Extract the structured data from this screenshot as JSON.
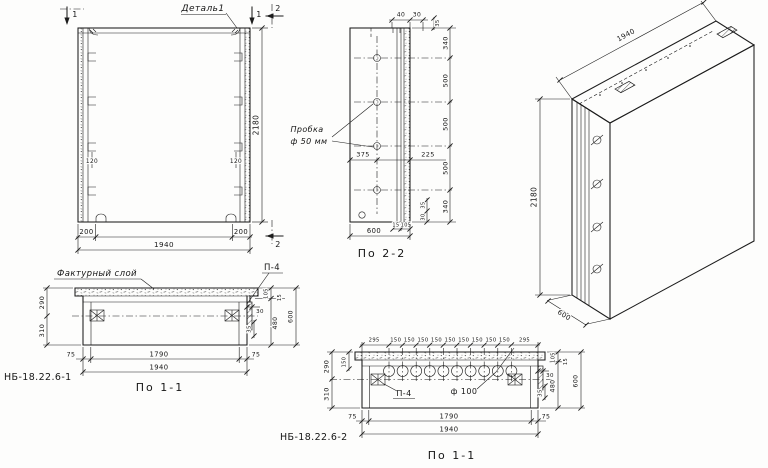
{
  "colors": {
    "ink": "#1c1c1c",
    "paper": "#fdfdfc"
  },
  "front": {
    "detail_label": "Деталь1",
    "sec1_left": "1",
    "sec1_right": "1",
    "sec2_top": "2",
    "sec2_bottom": "2",
    "dim_height": "2180",
    "dim_rib_left": "200",
    "dim_rib_right": "200",
    "dim_width": "1940",
    "key_left": "120",
    "key_right": "120"
  },
  "sec22": {
    "title": "По 2-2",
    "plug_line1": "Пробка",
    "plug_line2": "ф 50 мм",
    "dim_40": "40",
    "dim_30": "30",
    "dim_35_top": "35",
    "dim_375": "375",
    "dim_225": "225",
    "chain": [
      "340",
      "500",
      "500",
      "500",
      "340"
    ],
    "dim_15": "15",
    "dim_105": "105",
    "dim_30_rot": "30",
    "dim_35_rot": "35",
    "dim_600": "600"
  },
  "iso": {
    "dim_length": "1940",
    "dim_height": "2180",
    "dim_depth": "600"
  },
  "sec11a": {
    "mark": "НБ-18.22.6-1",
    "title": "По 1-1",
    "facing_label": "Фактурный слой",
    "p4": "П-4",
    "d290": "290",
    "d310": "310",
    "d30": "30",
    "d35": "35",
    "d105": "105",
    "d15": "15",
    "d480": "480",
    "d600": "600",
    "d75l": "75",
    "d1790": "1790",
    "d75r": "75",
    "d1940": "1940"
  },
  "sec11b": {
    "mark": "НБ-18.22.6-2",
    "title": "По 1-1",
    "p4": "П-4",
    "f100": "ф 100",
    "top_dims": [
      "295",
      "150",
      "150",
      "150",
      "150",
      "150",
      "150",
      "150",
      "150",
      "150",
      "295"
    ],
    "d290": "290",
    "d150": "150",
    "d310": "310",
    "d30": "30",
    "d35": "35",
    "d105": "105",
    "d15": "15",
    "d480": "480",
    "d600": "600",
    "d75l": "75",
    "d1790": "1790",
    "d75r": "75",
    "d1940": "1940"
  }
}
